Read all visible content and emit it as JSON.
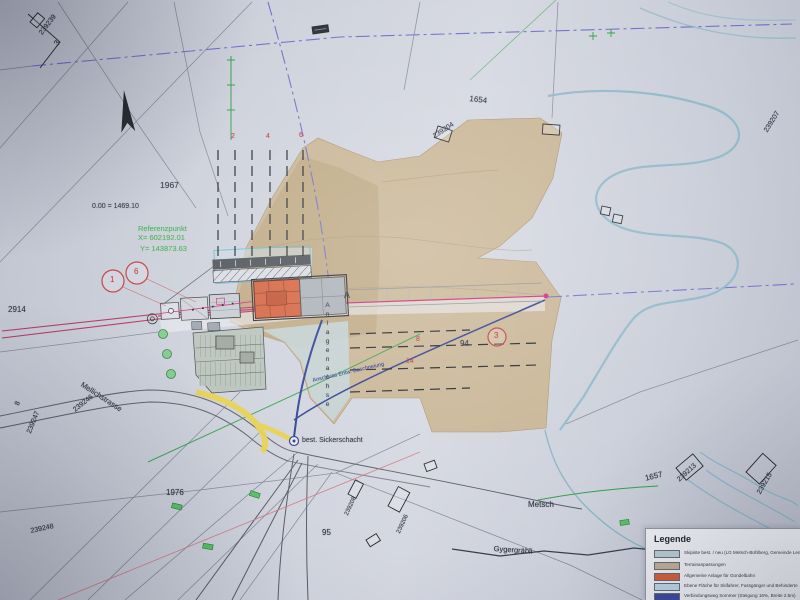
{
  "labels": {
    "survey_239239": "239239",
    "survey_239239_parcel": "3",
    "parcel_1654": "1654",
    "survey_239204": "239204",
    "survey_239207": "239207",
    "parcel_1967": "1967",
    "elevation_note": "0.00 = 1469.10",
    "ref_title": "Referenzpunkt",
    "ref_x": "X= 602192.01",
    "ref_y": "Y= 143873.63",
    "parcel_2914": "2914",
    "survey_239246": "239246",
    "survey_239247": "239247",
    "survey_239247_parcel": "8",
    "street_mellichstrasse": "Mellichstrasse",
    "parcel_1976": "1976",
    "survey_239248": "239248",
    "parcel_95": "95",
    "parcel_94": "94",
    "place_metsch": "Metsch",
    "stream_gygergraebli": "Gygergräbli",
    "parcel_1657": "1657",
    "survey_239213": "239213",
    "survey_239215": "239215",
    "survey_239208": "239208",
    "survey_239206": "239206",
    "note_sickerschacht": "best. Sickerschacht",
    "note_anschluss": "Anschluss Entw. Beschneiung",
    "axis_label": "Anlagenachse",
    "axis_point_a": "A",
    "gridline_2": "2",
    "gridline_4": "4",
    "gridline_6": "6",
    "gridline_8": "8",
    "gridline_14": "14",
    "marker_1": "1",
    "marker_6": "6",
    "marker_3": "3"
  },
  "legend": {
    "title": "Legende",
    "items": [
      {
        "color": "#b9ccd3",
        "label": "Skipiste best. / neu (LG Metsch-Bühlberg, Gemeinde Lenk)"
      },
      {
        "color": "#c2b098",
        "label": "Terrainanpassungen"
      },
      {
        "color": "#d4603c",
        "label": "Allgemeine Anlage für Gondelbahn"
      },
      {
        "color": "#bdd8e6",
        "label": "Ebene Fläche für Skifahrer, Fussgänger und Behinderte"
      },
      {
        "color": "#3c4a9e",
        "label": "Verbindungsweg Sommer (Steigung 16%, Breite 2.5m)"
      },
      {
        "color": "#5565b0",
        "label": "Verbindungsweg Winter"
      }
    ]
  },
  "colors": {
    "paper": "#ccd0da",
    "terrain_tan": "#c6ad84",
    "station_orange": "#d4603c",
    "axis_magenta": "#cc2a7a",
    "map_green": "#2f9e44",
    "path_dark_blue": "#2c3c92",
    "road_teal": "#8ab5c6",
    "path_yellow": "#e6d14a",
    "red_labels": "#c03a3a",
    "reference_green": "#3faf4f"
  }
}
